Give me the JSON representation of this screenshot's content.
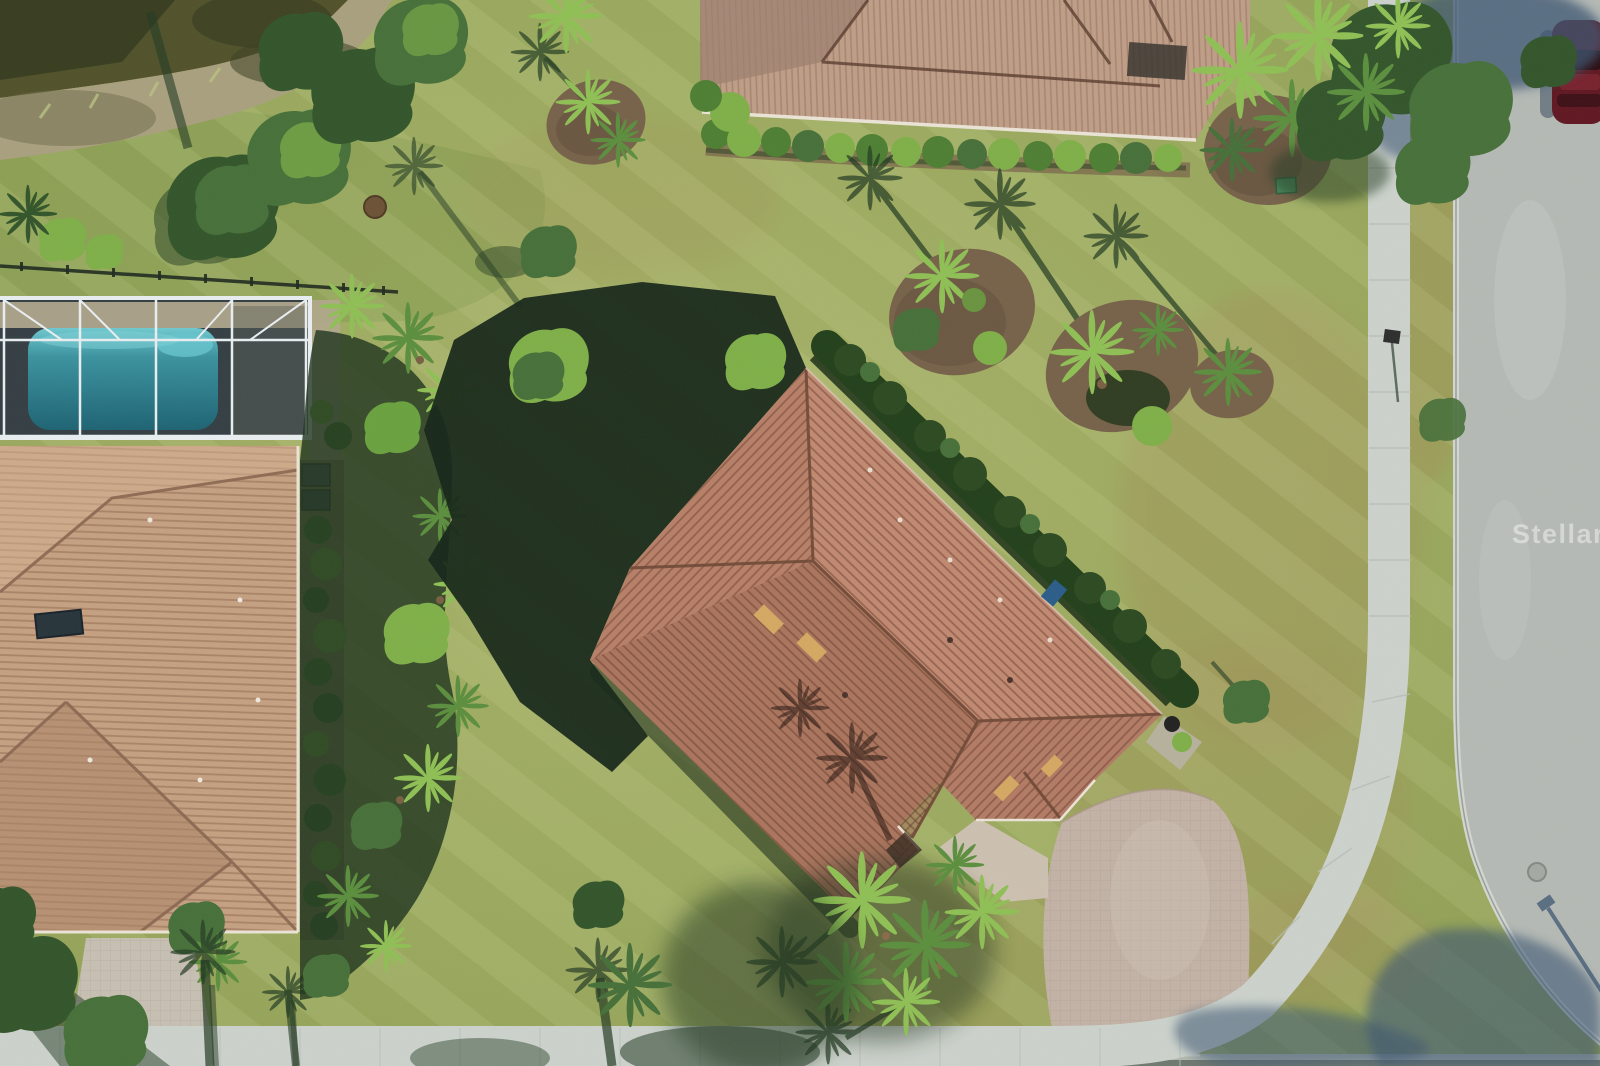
{
  "image": {
    "kind": "aerial-drone-photo",
    "description": "Top-down aerial view of a single-family home with terracotta tile hip roof on a corner lot, paver driveway, neighboring house with screened pool enclosure at left, second neighboring house at top, pond at top-left, curving street with sidewalk at right and bottom, tropical landscaping with palms and garden beds",
    "width_px": 1600,
    "height_px": 1066
  },
  "watermark": {
    "text": "Stellar MLS"
  },
  "colors": {
    "grass_base": "#9aa85e",
    "grass_light": "#aab56c",
    "grass_dark": "#7c974b",
    "grass_brown": "#a1955a",
    "shadow_green": "#243b24",
    "shadow_deep": "#152619",
    "pond_water": "#51522b",
    "pond_dark": "#343a1e",
    "bank_sand": "#a9a07f",
    "road_gray": "#b5bab6",
    "sidewalk_gray": "#cdd3cd",
    "curb_light": "#d2d7d2",
    "shadow_blue": "#3e5673",
    "paver_main": "#c4b3a7",
    "paver_light": "#d0c2b5",
    "paver_left": "#c7c0b4",
    "pool_teal": "#2a7c8c",
    "pool_aqua": "#67c6cf",
    "deck_tan": "#b3a88e",
    "screen_dark": "#343e44",
    "frame_white": "#eaeff2",
    "fence_dark": "#202a20",
    "roof_main": "#b87f68",
    "roof_main_dark": "#9a6751",
    "roof_line": "#6f4836",
    "roof_left": "#c6a183",
    "roof_left_dark": "#ad8568",
    "roof_top": "#c09e88",
    "roof_top_dark": "#9e8070",
    "gutter_white": "#ece5d8",
    "mulch_brown": "#77624a",
    "mulch_dark": "#5d4b39",
    "hedge_green": "#4e7f33",
    "hedge_dark": "#2c4a22",
    "foliage_dark": "#33552b",
    "foliage_mid": "#47703a",
    "foliage_bright": "#7fb049",
    "palm_green": "#5c8f3f",
    "palm_bright": "#8fc055",
    "car_red": "#611722",
    "car_dark": "#260b10",
    "skylight_amber": "#d5a963",
    "watermark_white": "rgba(255,255,255,0.45)"
  },
  "scene": {
    "objects": [
      {
        "name": "main-house-roof",
        "label": "terracotta tile hip roof, diamond orientation"
      },
      {
        "name": "main-driveway",
        "label": "curved paver driveway to corner street"
      },
      {
        "name": "front-palm-cluster",
        "label": "palm trees at front entry"
      },
      {
        "name": "left-house-roof",
        "label": "neighboring house tan tile roof"
      },
      {
        "name": "pool-enclosure",
        "label": "screened pool cage with blue pool"
      },
      {
        "name": "top-house-roof",
        "label": "neighboring house at top with hedge"
      },
      {
        "name": "pond",
        "label": "dark pond at top-left with sandy bank"
      },
      {
        "name": "road",
        "label": "concrete street curving right to bottom"
      },
      {
        "name": "sidewalk",
        "label": "sidewalk paralleling street"
      },
      {
        "name": "garden-beds",
        "label": "mulch island beds with palms"
      },
      {
        "name": "parked-car",
        "label": "dark red car at top right street edge"
      },
      {
        "name": "manhole-cover",
        "label": "manhole on road"
      },
      {
        "name": "watermark",
        "label": "Stellar MLS watermark"
      }
    ]
  }
}
